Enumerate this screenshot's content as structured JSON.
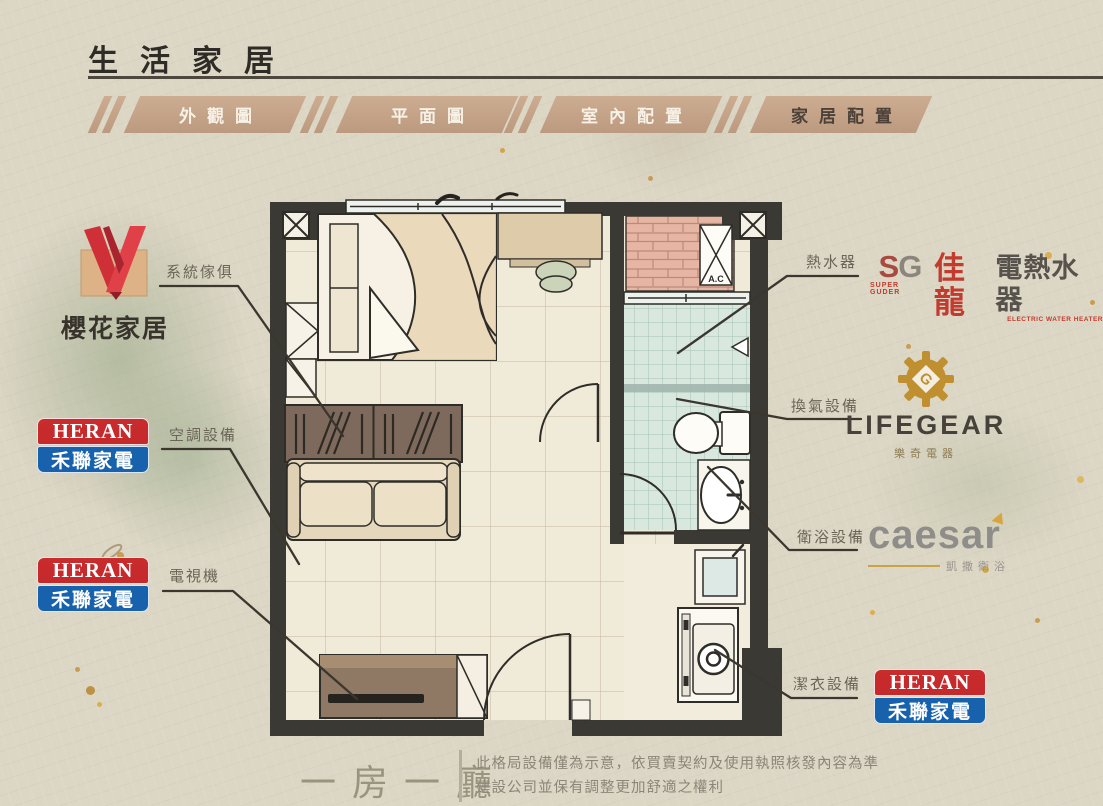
{
  "header": {
    "title": "生活家居"
  },
  "tabs": [
    {
      "label": "外觀圖",
      "active": false
    },
    {
      "label": "平面圖",
      "active": false
    },
    {
      "label": "室內配置",
      "active": false
    },
    {
      "label": "家居配置",
      "active": true
    }
  ],
  "annotations": {
    "system_furniture": "系統傢俱",
    "air_conditioner": "空調設備",
    "tv": "電視機",
    "water_heater": "熱水器",
    "ventilation": "換氣設備",
    "bathroom": "衛浴設備",
    "laundry": "潔衣設備"
  },
  "plan": {
    "ac_label": "A.C"
  },
  "logos": {
    "sakura": {
      "name": "櫻花家居"
    },
    "heran": {
      "en": "HERAN",
      "zh": "禾聯家電"
    },
    "jialong": {
      "prefix_s": "S",
      "prefix_g": "G",
      "sub": "SUPER GUDER",
      "brand": "佳龍",
      "product": "電熱水器",
      "sub2": "ELECTRIC WATER HEATER"
    },
    "lifegear": {
      "en": "LIFEGEAR",
      "zh": "樂奇電器"
    },
    "caesar": {
      "en": "caesar",
      "zh": "凱撒衛浴"
    }
  },
  "footer": {
    "plan_type": "一房一廳",
    "disclaimer_line1": "此格局設備僅為示意，依買賣契約及使用執照核發內容為準",
    "disclaimer_line2": "建設公司並保有調整更加舒適之權利"
  }
}
